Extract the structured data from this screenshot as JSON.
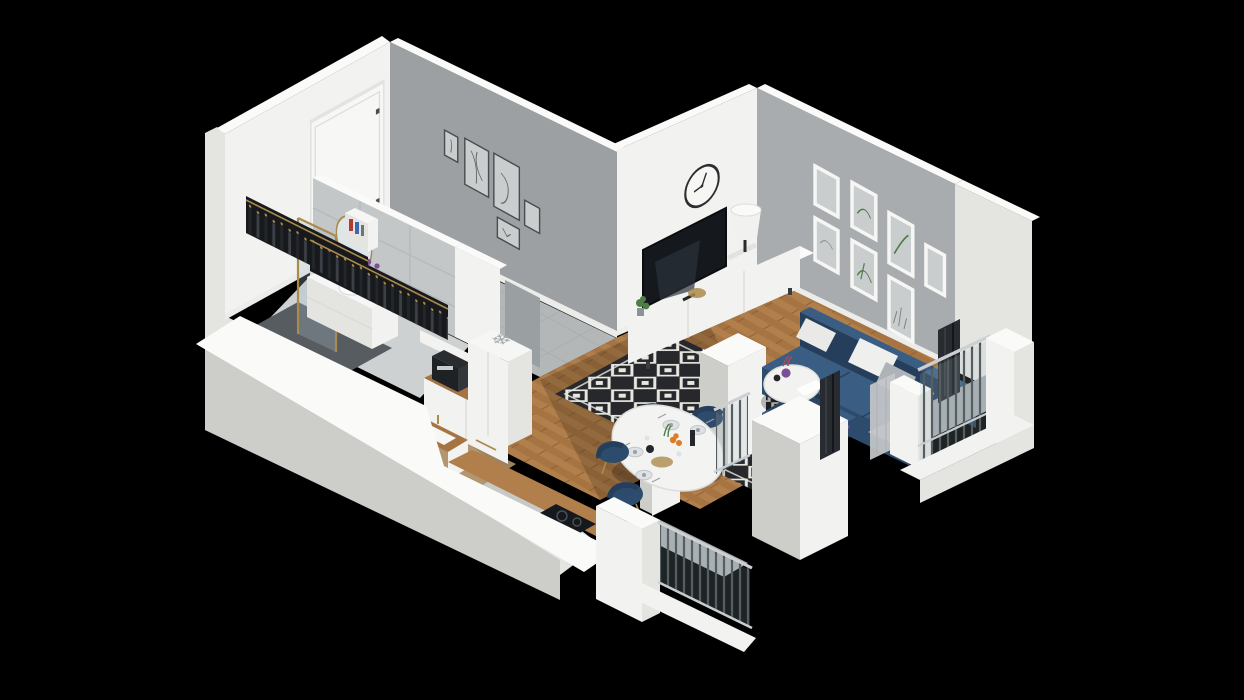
{
  "scene": {
    "type": "3d-isometric-floorplan-render",
    "background": "black",
    "description": "Dollhouse cutaway 3D render of a small apartment, viewed isometrically from the south-east, on a black background",
    "kitchen_snowflake_glyph": "❄",
    "rooms": [
      {
        "name": "entry-hall",
        "floor": "grey ceramic tile",
        "features": [
          "white entrance door with dark handle",
          "open wardrobe rails with hanging clothes on wooden hangers",
          "small white shelf with books",
          "gallery wall with 5 framed line-art prints"
        ]
      },
      {
        "name": "bathroom",
        "floor": "light tile with dark grey shower zone",
        "features": [
          "walk-in shower with gold-framed glass",
          "white vanity cabinet with basin",
          "gold faucet",
          "oval gold-rimmed mirror",
          "purple toiletry bottles",
          "grey open door"
        ]
      },
      {
        "name": "kitchen",
        "floor": "light oak strip",
        "features": [
          "tall white fridge cabinet with snowflake symbol on top",
          "black espresso machine",
          "white drawer fronts with gold handles",
          "wood worktop",
          "white inset sink with gold tap",
          "black induction hob"
        ]
      },
      {
        "name": "living-room",
        "floor": "chevron oak parquet",
        "features": [
          "round wall clock",
          "lean-back flat screen TV",
          "white low media console",
          "white drum table lamp on books",
          "gold decorative tray",
          "small potted plant",
          "gallery wall with 7 framed botanical prints",
          "black and white diamond-pattern rug",
          "navy corner sofa with chaise",
          "white, grey and purple throw pillows",
          "round white coffee table with purple vase",
          "white partition column"
        ]
      },
      {
        "name": "dining-area",
        "floor": "chevron oak parquet",
        "features": [
          "oval white pedestal table",
          "4 navy upholstered chairs with gold legs",
          "set plates with cutlery",
          "bowl of oranges",
          "dark bottle and teapot",
          "glasses and greenery"
        ]
      },
      {
        "name": "balcony-south",
        "features": [
          "white parapet blocks",
          "steel baluster railing with light handrail",
          "glass infill"
        ]
      },
      {
        "name": "balcony-east",
        "features": [
          "white parapet and corner columns",
          "steel baluster railing",
          "sheer grey curtain",
          "dark pleated drapes"
        ]
      }
    ],
    "counts": {
      "hall_gallery_frames": 5,
      "living_gallery_frames": 7,
      "dining_chairs": 4,
      "dining_plates": 4,
      "sofa_pillows": 5
    },
    "sofa_pillow_colors": [
      "white",
      "white",
      "grey",
      "white",
      "purple"
    ]
  },
  "palette": {
    "bg": "#000000",
    "wallFace": "#f2f2f0",
    "wallTop": "#fafaf8",
    "wallSide": "#e4e4e1",
    "wallShade": "#cdcdc9",
    "grayWallA": "#9da0a3",
    "grayWallB": "#a9acaf",
    "skirting": "#ececea",
    "white": "#f6f6f4",
    "tileBase": "#b4b7b8",
    "tileLine": "#a5a8a9",
    "wood1": "#b07f4b",
    "wood2": "#a57442",
    "wood3": "#8f6136",
    "woodLight": "#c8a478",
    "rugDark": "#26282c",
    "rugLight": "#e9e7e1",
    "navyTop": "#3a5d84",
    "navyFront": "#2d4b6d",
    "navyDark": "#243e5b",
    "tvBlack": "#15191d",
    "gold": "#ab8b4d",
    "glass": "#a9c0ca",
    "railBar": "#45494f",
    "railFrame": "#ccd0d3",
    "curtain": "#c5c8ca",
    "drape": "#282b2f",
    "purple": "#7b4f95",
    "orange": "#e07b28",
    "green": "#4e7d45",
    "plate": "#dfe2e4",
    "artGray": "#c9cdce"
  }
}
